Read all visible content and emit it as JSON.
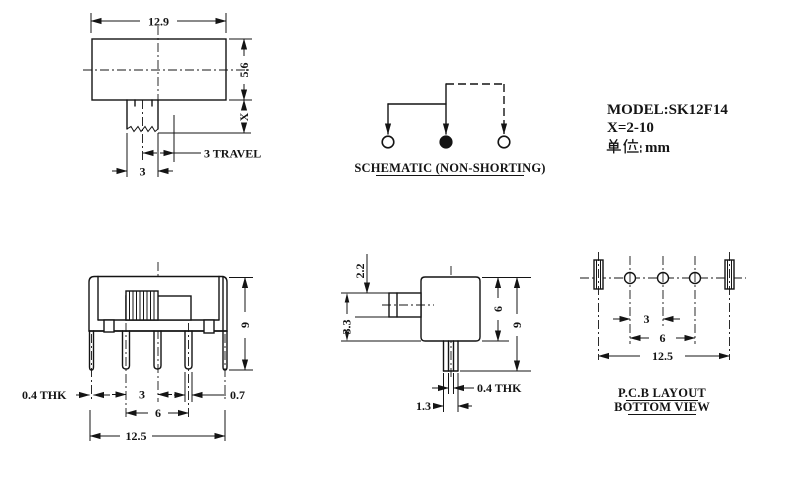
{
  "colors": {
    "ink": "#141414",
    "paper": "#ffffff"
  },
  "title_block": {
    "model": "MODEL:SK12F14",
    "x_range": "X=2-10",
    "unit_label": "单位:",
    "unit_value": "mm"
  },
  "schematic": {
    "caption": "SCHEMATIC (NON-SHORTING)"
  },
  "top_view": {
    "body_width": "12.9",
    "body_height": "5.6",
    "handle_height": "X",
    "travel": "3 TRAVEL",
    "handle_width": "3"
  },
  "front_view": {
    "overall_height": "9",
    "tab_thickness": "0.4 THK",
    "pin_pitch": "3",
    "pin_width": "0.7",
    "pin_span": "6",
    "overall_width": "12.5"
  },
  "side_view": {
    "knob_thickness": "2.2",
    "knob_offset": "3.3",
    "body_depth": "6",
    "overall_height": "9",
    "pin_thickness": "0.4 THK",
    "pin_width": "1.3"
  },
  "pcb_view": {
    "hole_pitch": "3",
    "hole_span": "6",
    "slot_span": "12.5",
    "caption_line1": "P.C.B LAYOUT",
    "caption_line2": "BOTTOM VIEW"
  }
}
